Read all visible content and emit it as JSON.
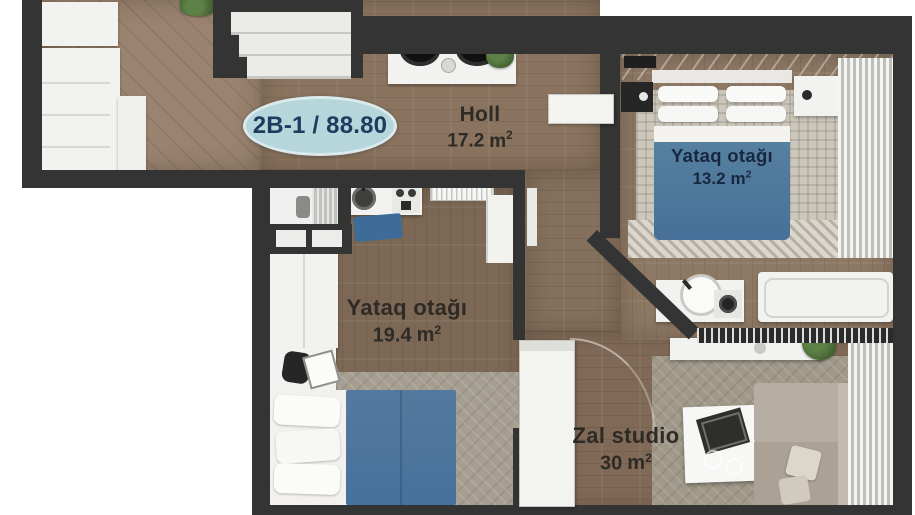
{
  "plan": {
    "badge": "2B-1 / 88.80",
    "rooms": {
      "holl": {
        "name": "Holl",
        "area": "17.2",
        "unit": "m",
        "sup": "2"
      },
      "bedroom_small": {
        "name": "Yataq otağı",
        "area": "13.2",
        "unit": "m",
        "sup": "2"
      },
      "bedroom_large": {
        "name": "Yataq otağı",
        "area": "19.4",
        "unit": "m",
        "sup": "2"
      },
      "living": {
        "name": "Zal studio",
        "area": "30",
        "unit": "m",
        "sup": "2"
      }
    },
    "colors": {
      "wall": "#343434",
      "wood_entrance": "#9a8470",
      "wood_hall": "#8a745f",
      "wood_bedroom_small": "#8d7864",
      "wood_bedroom_large": "#7c6854",
      "wood_living": "#806957",
      "blanket_blue": "#4c77a2",
      "badge_bg": "#b7d6db",
      "badge_text": "#1f3c60",
      "label_text": "#2e2b27",
      "rug_checker": "#ccc6bb",
      "rug_gray": "#a09989",
      "sofa": "#b2aa9f",
      "plant_green": "#4e7039"
    }
  }
}
